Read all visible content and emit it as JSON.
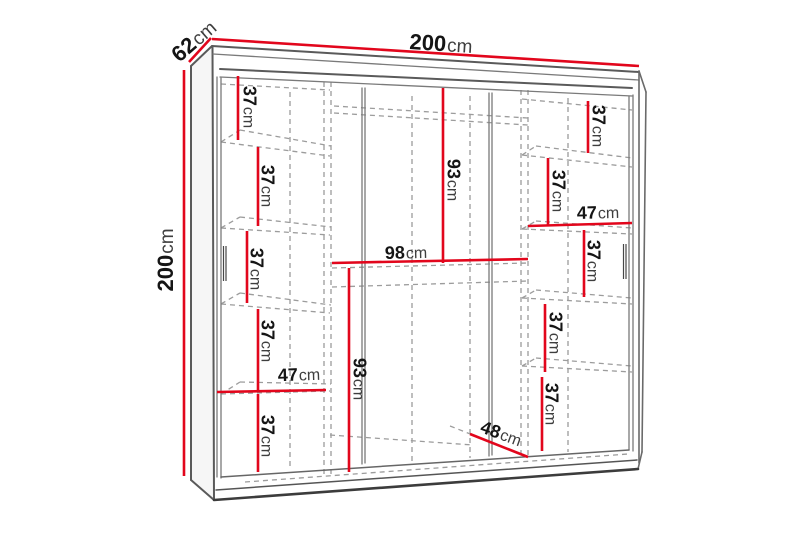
{
  "diagram": {
    "subject": "wardrobe-dimension-diagram",
    "unit": "cm",
    "colors": {
      "dimension_line": "#e2061c",
      "structure_line": "#5a5a5a",
      "hidden_line": "#9c9c9c",
      "background": "#ffffff"
    },
    "measurements": {
      "width_top": {
        "value": "200",
        "unit": "cm"
      },
      "depth_top": {
        "value": "62",
        "unit": "cm"
      },
      "height_left": {
        "value": "200",
        "unit": "cm"
      },
      "left_column": {
        "compartment_1": {
          "value": "37",
          "unit": "cm"
        },
        "compartment_2": {
          "value": "37",
          "unit": "cm"
        },
        "compartment_3": {
          "value": "37",
          "unit": "cm"
        },
        "compartment_4": {
          "value": "37",
          "unit": "cm"
        },
        "column_width": {
          "value": "47",
          "unit": "cm"
        },
        "compartment_5": {
          "value": "37",
          "unit": "cm"
        }
      },
      "middle_column": {
        "upper_section_height": {
          "value": "93",
          "unit": "cm"
        },
        "shelf_width": {
          "value": "98",
          "unit": "cm"
        },
        "lower_section_height": {
          "value": "93",
          "unit": "cm"
        },
        "bottom_width": {
          "value": "48",
          "unit": "cm"
        }
      },
      "right_column": {
        "compartment_1": {
          "value": "37",
          "unit": "cm"
        },
        "compartment_2": {
          "value": "37",
          "unit": "cm"
        },
        "column_width": {
          "value": "47",
          "unit": "cm"
        },
        "compartment_3": {
          "value": "37",
          "unit": "cm"
        },
        "compartment_4": {
          "value": "37",
          "unit": "cm"
        },
        "compartment_5": {
          "value": "37",
          "unit": "cm"
        }
      }
    }
  }
}
